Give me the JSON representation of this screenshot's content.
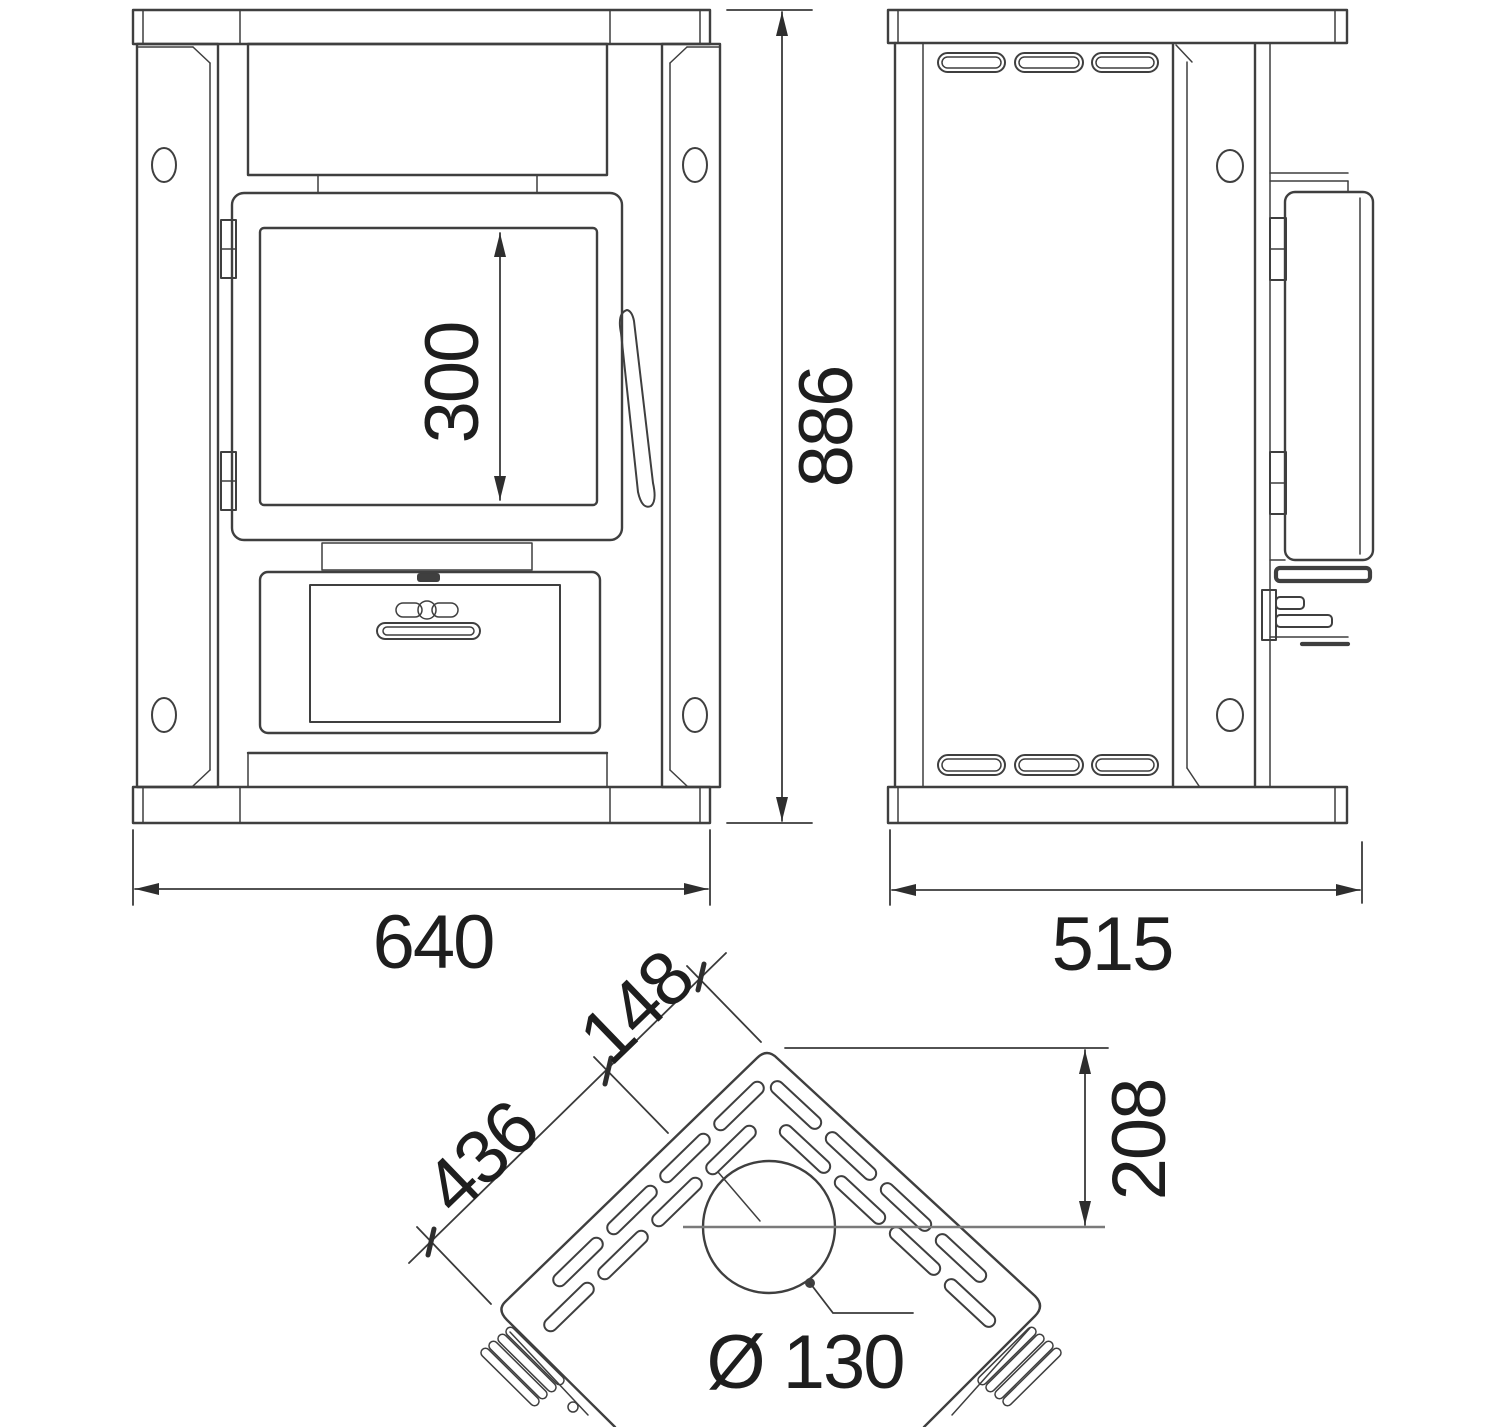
{
  "drawing": {
    "background_color": "#ffffff",
    "ink_color": "#3f3f3f",
    "label_color": "#1e1e1e",
    "dimensions": {
      "glass_height": "300",
      "overall_height": "886",
      "overall_width": "640",
      "overall_depth": "515",
      "side_panel_width": "436",
      "top_corner_segment": "148",
      "flue_center_from_corner": "208",
      "flue_diameter": "Ø 130"
    }
  }
}
